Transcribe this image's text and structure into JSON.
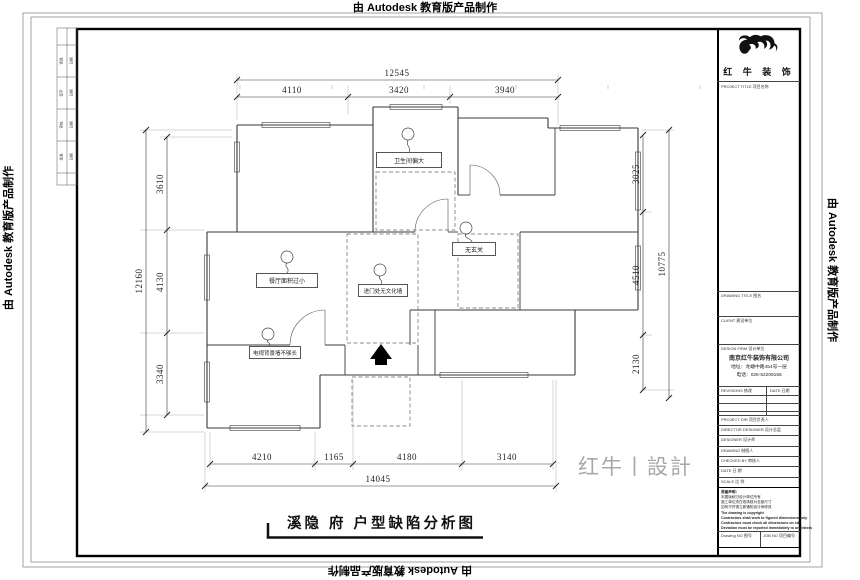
{
  "watermarks": {
    "autodesk": "由 Autodesk 教育版产品制作"
  },
  "sheet": {
    "title": "溪隐 府 户型缺陷分析图",
    "design_watermark": "红牛丨設計"
  },
  "plan": {
    "labels": {
      "bathroom": "卫生间偏大",
      "foyer": "无玄关",
      "dining": "餐厅面积过小",
      "entry": "进门处无文化墙",
      "tv_wall": "电视背景墙不够长"
    },
    "dims": {
      "top": {
        "overall": "12545",
        "segments": [
          "4110",
          "3420",
          "3940"
        ]
      },
      "left": {
        "overall": "12160",
        "segments": [
          "3610",
          "4130",
          "3340"
        ]
      },
      "right": {
        "overall": "10775",
        "segments": [
          "3025",
          "4510",
          "2130"
        ]
      },
      "bottom": {
        "overall": "14045",
        "segments": [
          "4210",
          "1165",
          "4180",
          "3140"
        ]
      }
    }
  },
  "titleblock": {
    "brand": "红 牛 装 饰",
    "sections": {
      "project_title": "PROJECT TITLE 项目名称",
      "drawing_title": "DRAWING TITLE 图名",
      "client": "CLIENT 建设单位",
      "design_firm": "DESIGN FIRM 设计单位"
    },
    "company": {
      "name": "南京红牛装饰有限公司",
      "address": "地址：龙蟠中路454号一层",
      "phone": "电话：025-52209155"
    },
    "revisions": {
      "left": "REVISIONS 修改",
      "right": "DATE 日期"
    },
    "rows": [
      "PROJECT DIR 项目负责人",
      "DIRECTOR DESIGNER 设计总监",
      "DESIGNER 设计师",
      "DRAWING 制图人",
      "CHECKED BY 审核人",
      "DATE 日 期",
      "SCALE 比 例"
    ],
    "notes": [
      "郑重声明：",
      "本图版权归设计单位所有",
      "施工单位须在现场核对全部尺寸",
      "如有不符请立即通知设计师修改",
      "The drawing is copyright",
      "Contractors shall work to figured dimensions only",
      "Contractors must check all dimensions on site",
      "Deviation must be reported immediately to architects"
    ],
    "footer": {
      "left": "Drawing NO 图号",
      "right": "JOB NO 项目编号"
    }
  },
  "fold_strip": [
    "修改",
    "日期",
    "签字",
    "日期",
    "审核",
    "日期",
    "批准",
    "日期"
  ]
}
